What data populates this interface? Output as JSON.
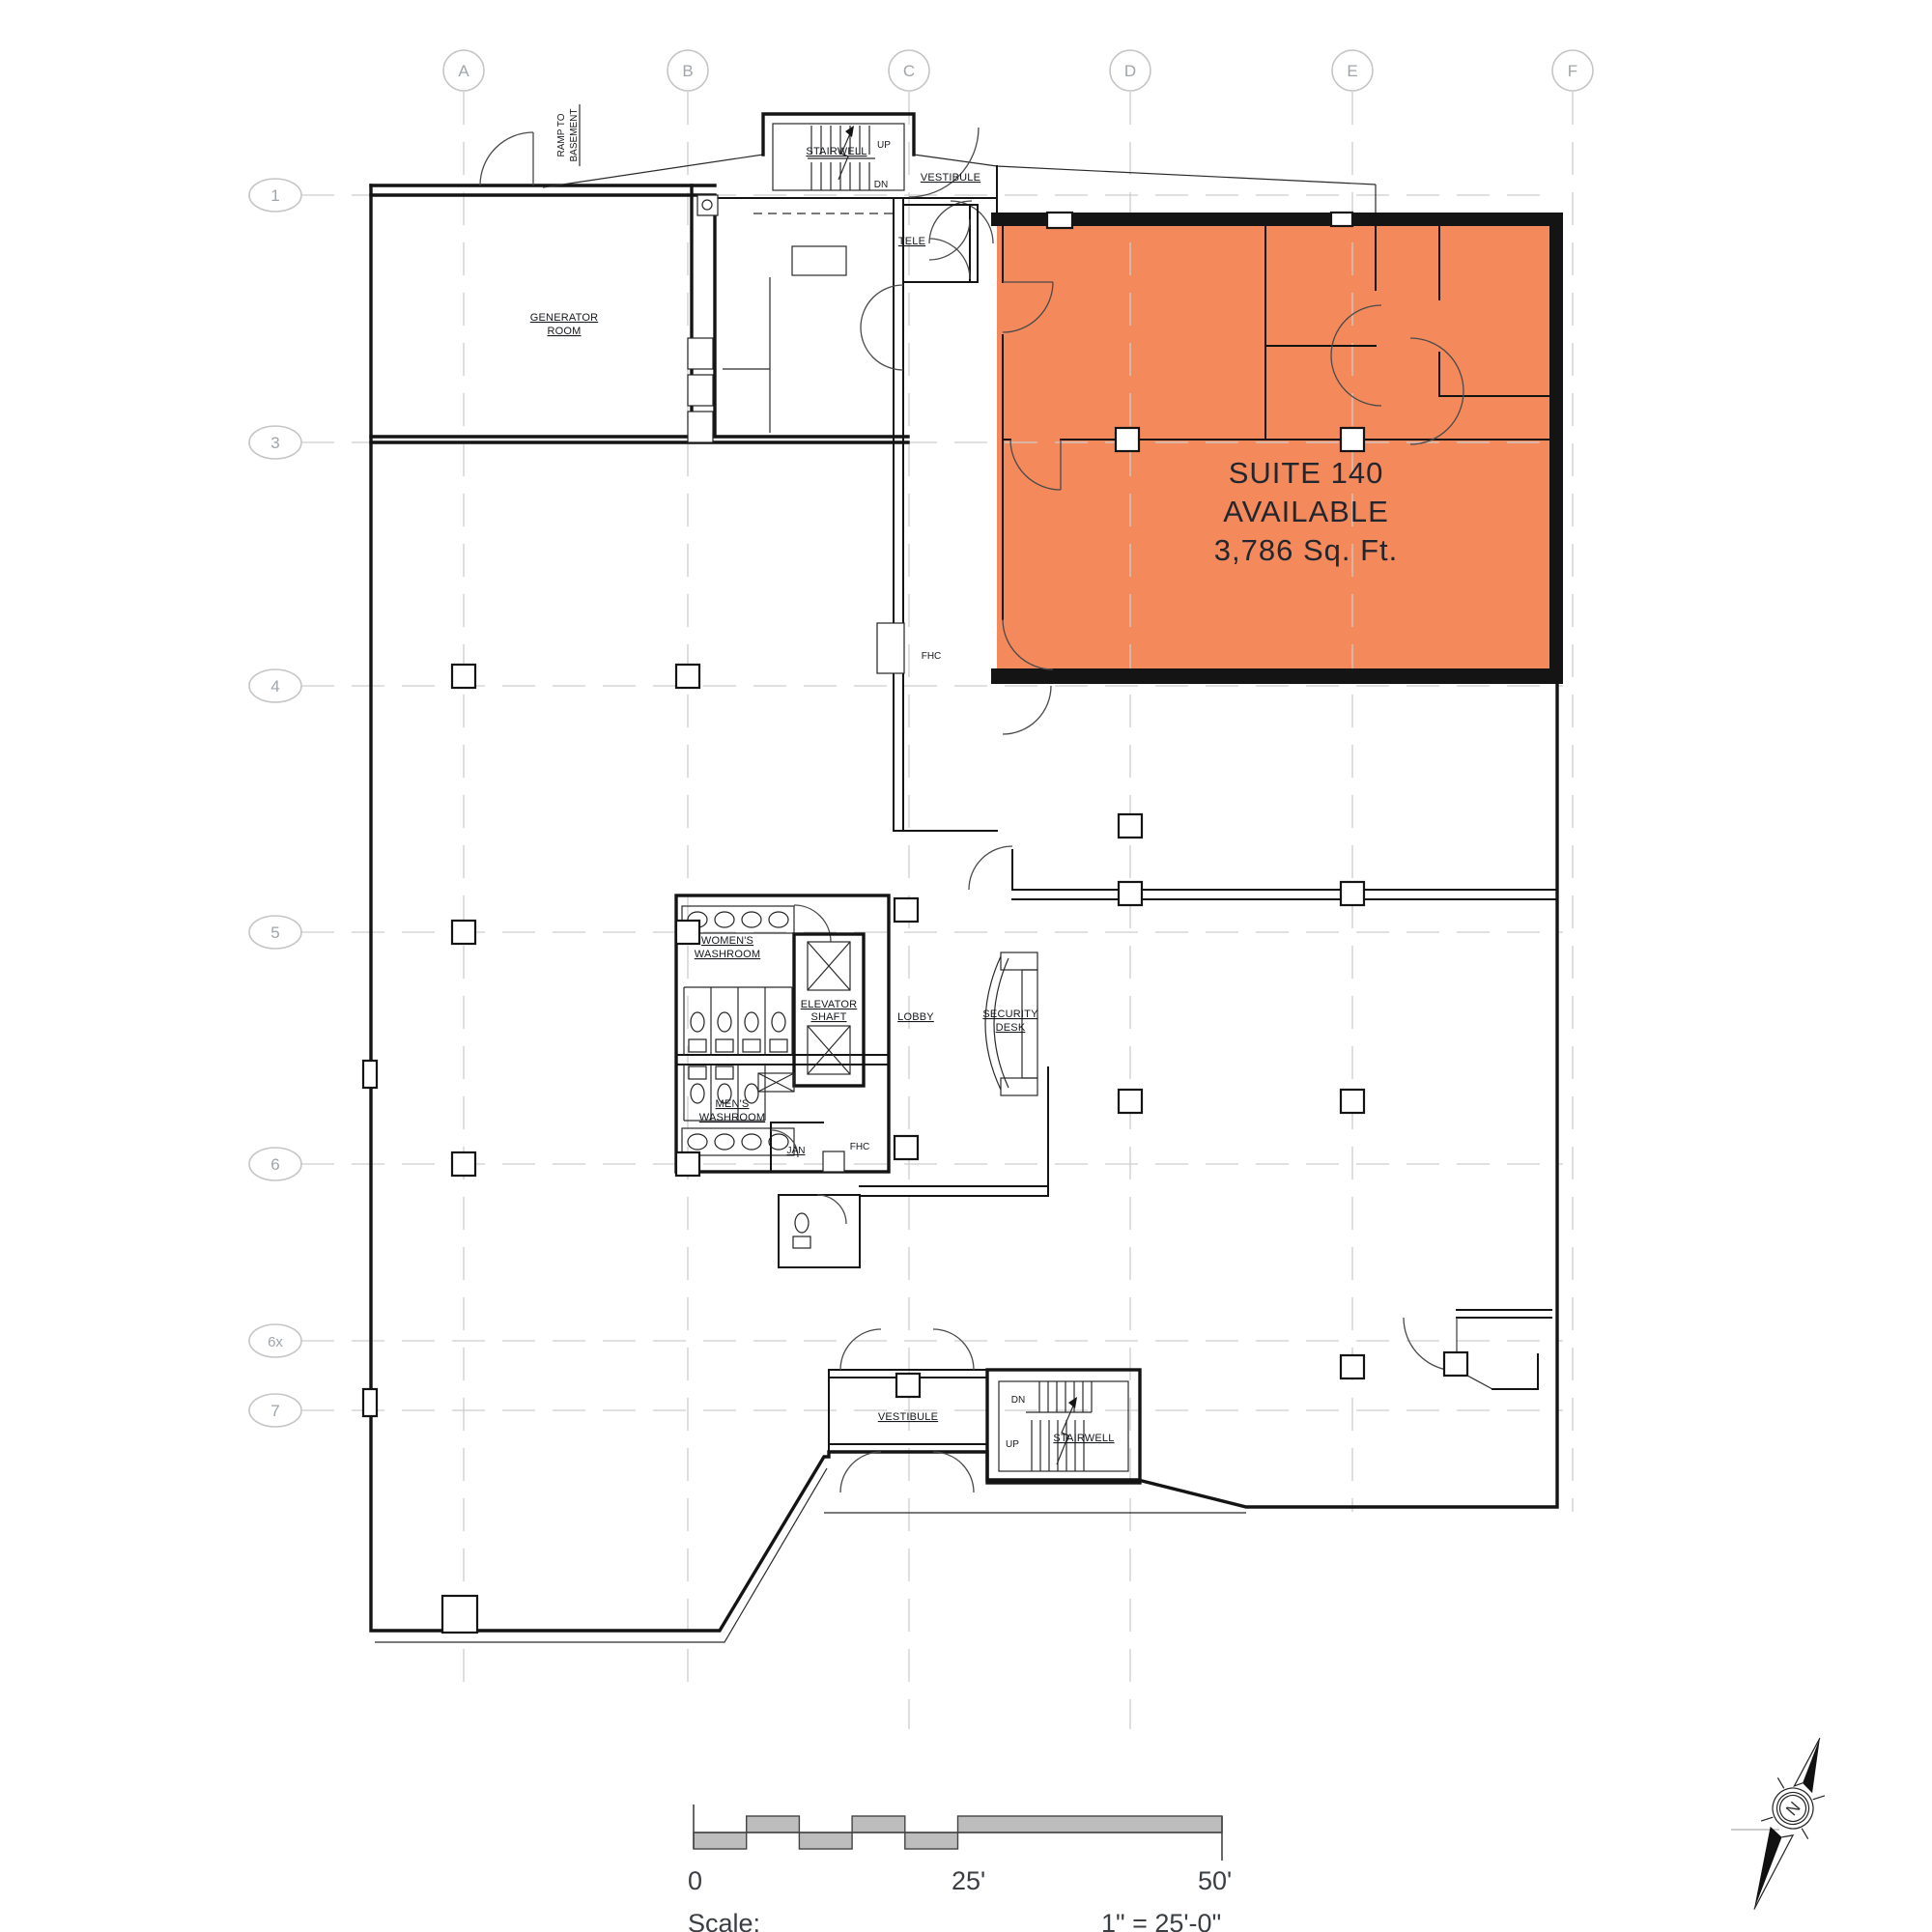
{
  "document": {
    "type": "architectural-floor-plan",
    "highlighted_listing": "Suite 140"
  },
  "suite": {
    "name": "SUITE 140",
    "status": "AVAILABLE",
    "area": "3,786 Sq. Ft.",
    "highlight_color": "#F4895C"
  },
  "grid": {
    "columns": [
      "A",
      "B",
      "C",
      "D",
      "E",
      "F"
    ],
    "rows": [
      "1",
      "3",
      "4",
      "5",
      "6",
      "6x",
      "7"
    ]
  },
  "rooms": {
    "generator_line1": "GENERATOR",
    "generator_line2": "ROOM",
    "stairwell_top": "STAIRWELL",
    "vestibule_top": "VESTIBULE",
    "tele": "TELE",
    "womens_line1": "WOMEN'S",
    "womens_line2": "WASHROOM",
    "mens_line1": "MEN'S",
    "mens_line2": "WASHROOM",
    "elevator_line1": "ELEVATOR",
    "elevator_line2": "SHAFT",
    "lobby": "LOBBY",
    "security_line1": "SECURITY",
    "security_line2": "DESK",
    "jan": "JAN",
    "vestibule_bottom": "VESTIBULE",
    "stairwell_bottom": "STAIRWELL"
  },
  "annotations": {
    "ramp_line1": "RAMP TO",
    "ramp_line2": "BASEMENT",
    "fhc_upper": "FHC",
    "fhc_lower": "FHC",
    "up_top": "UP",
    "dn_top": "DN",
    "up_bottom": "UP",
    "dn_bottom": "DN"
  },
  "scale_bar": {
    "start_label": "0",
    "mid_label": "25'",
    "end_label": "50'",
    "caption": "Scale;",
    "ratio": "1\" = 25'-0\""
  },
  "compass": {
    "north_letter": "N"
  },
  "colors": {
    "suite_fill": "#F4895C",
    "wall": "#141414",
    "grid_line": "#cdcdcd",
    "scale_fill": "#bdbdbd",
    "label_gray": "#9fa5ab",
    "text_dark": "#22262e"
  }
}
